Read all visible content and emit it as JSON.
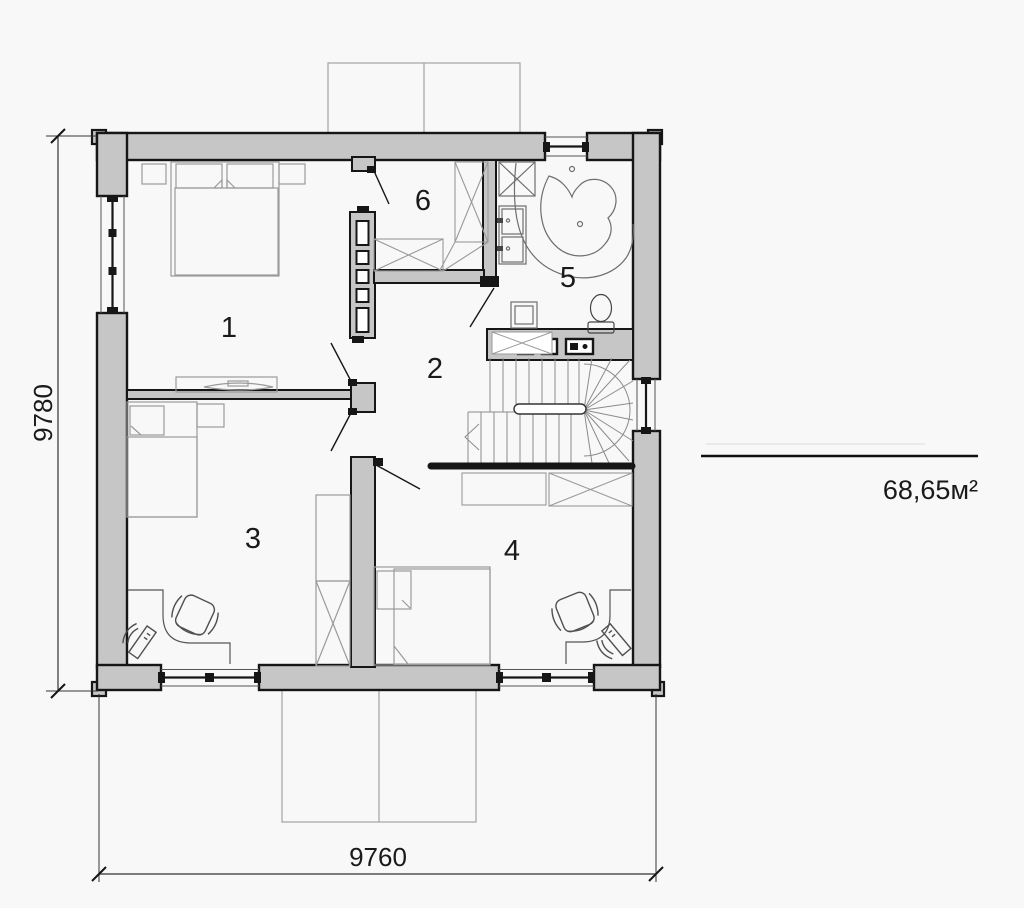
{
  "plan": {
    "type": "floor-plan-second-level",
    "area_label": "68,65м²",
    "dimension_height": "9780",
    "dimension_width": "9760",
    "rooms": [
      {
        "number": "1"
      },
      {
        "number": "2"
      },
      {
        "number": "3"
      },
      {
        "number": "4"
      },
      {
        "number": "5"
      },
      {
        "number": "6"
      }
    ],
    "colors": {
      "background": "#f8f8f8",
      "wall_fill": "#c6c6c6",
      "outline": "#161616",
      "furniture_light": "#9a9a9a",
      "furniture_dark": "#4f4f4f",
      "fixture": "#6e6e6e",
      "stairs": "#8c8c8c"
    }
  }
}
